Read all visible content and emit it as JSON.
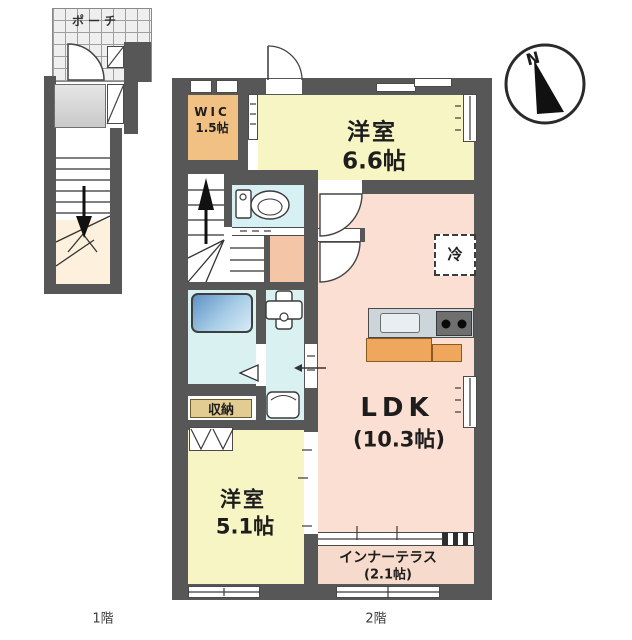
{
  "labels": {
    "porch": "ポーチ",
    "floor1": "1階",
    "floor2": "2階",
    "compass_n": "N",
    "wic_name": "WIC",
    "wic_size": "1.5帖",
    "bedroom_a_name": "洋室",
    "bedroom_a_size": "6.6帖",
    "refrigerator": "冷",
    "ldk_name": "LDK",
    "ldk_size": "(10.3帖)",
    "bedroom_b_name": "洋室",
    "bedroom_b_size": "5.1帖",
    "terrace_name": "インナーテラス",
    "terrace_size": "(2.1帖)",
    "storage": "収納"
  },
  "colors": {
    "wall": "#575757",
    "bedroom_yellow": "#f8f5c5",
    "wic_orange": "#f0c183",
    "ldk_pink": "#fbdfd2",
    "hall_salmon": "#f5c5a8",
    "wet_area_cyan": "#d9f1f0",
    "terrace_pink": "#f6dacc",
    "stair_cream": "#fdf0dc",
    "storage_tan": "#e3cc91",
    "counter_orange": "#efa75d",
    "bathtub_blue": "#6a9cc9"
  }
}
